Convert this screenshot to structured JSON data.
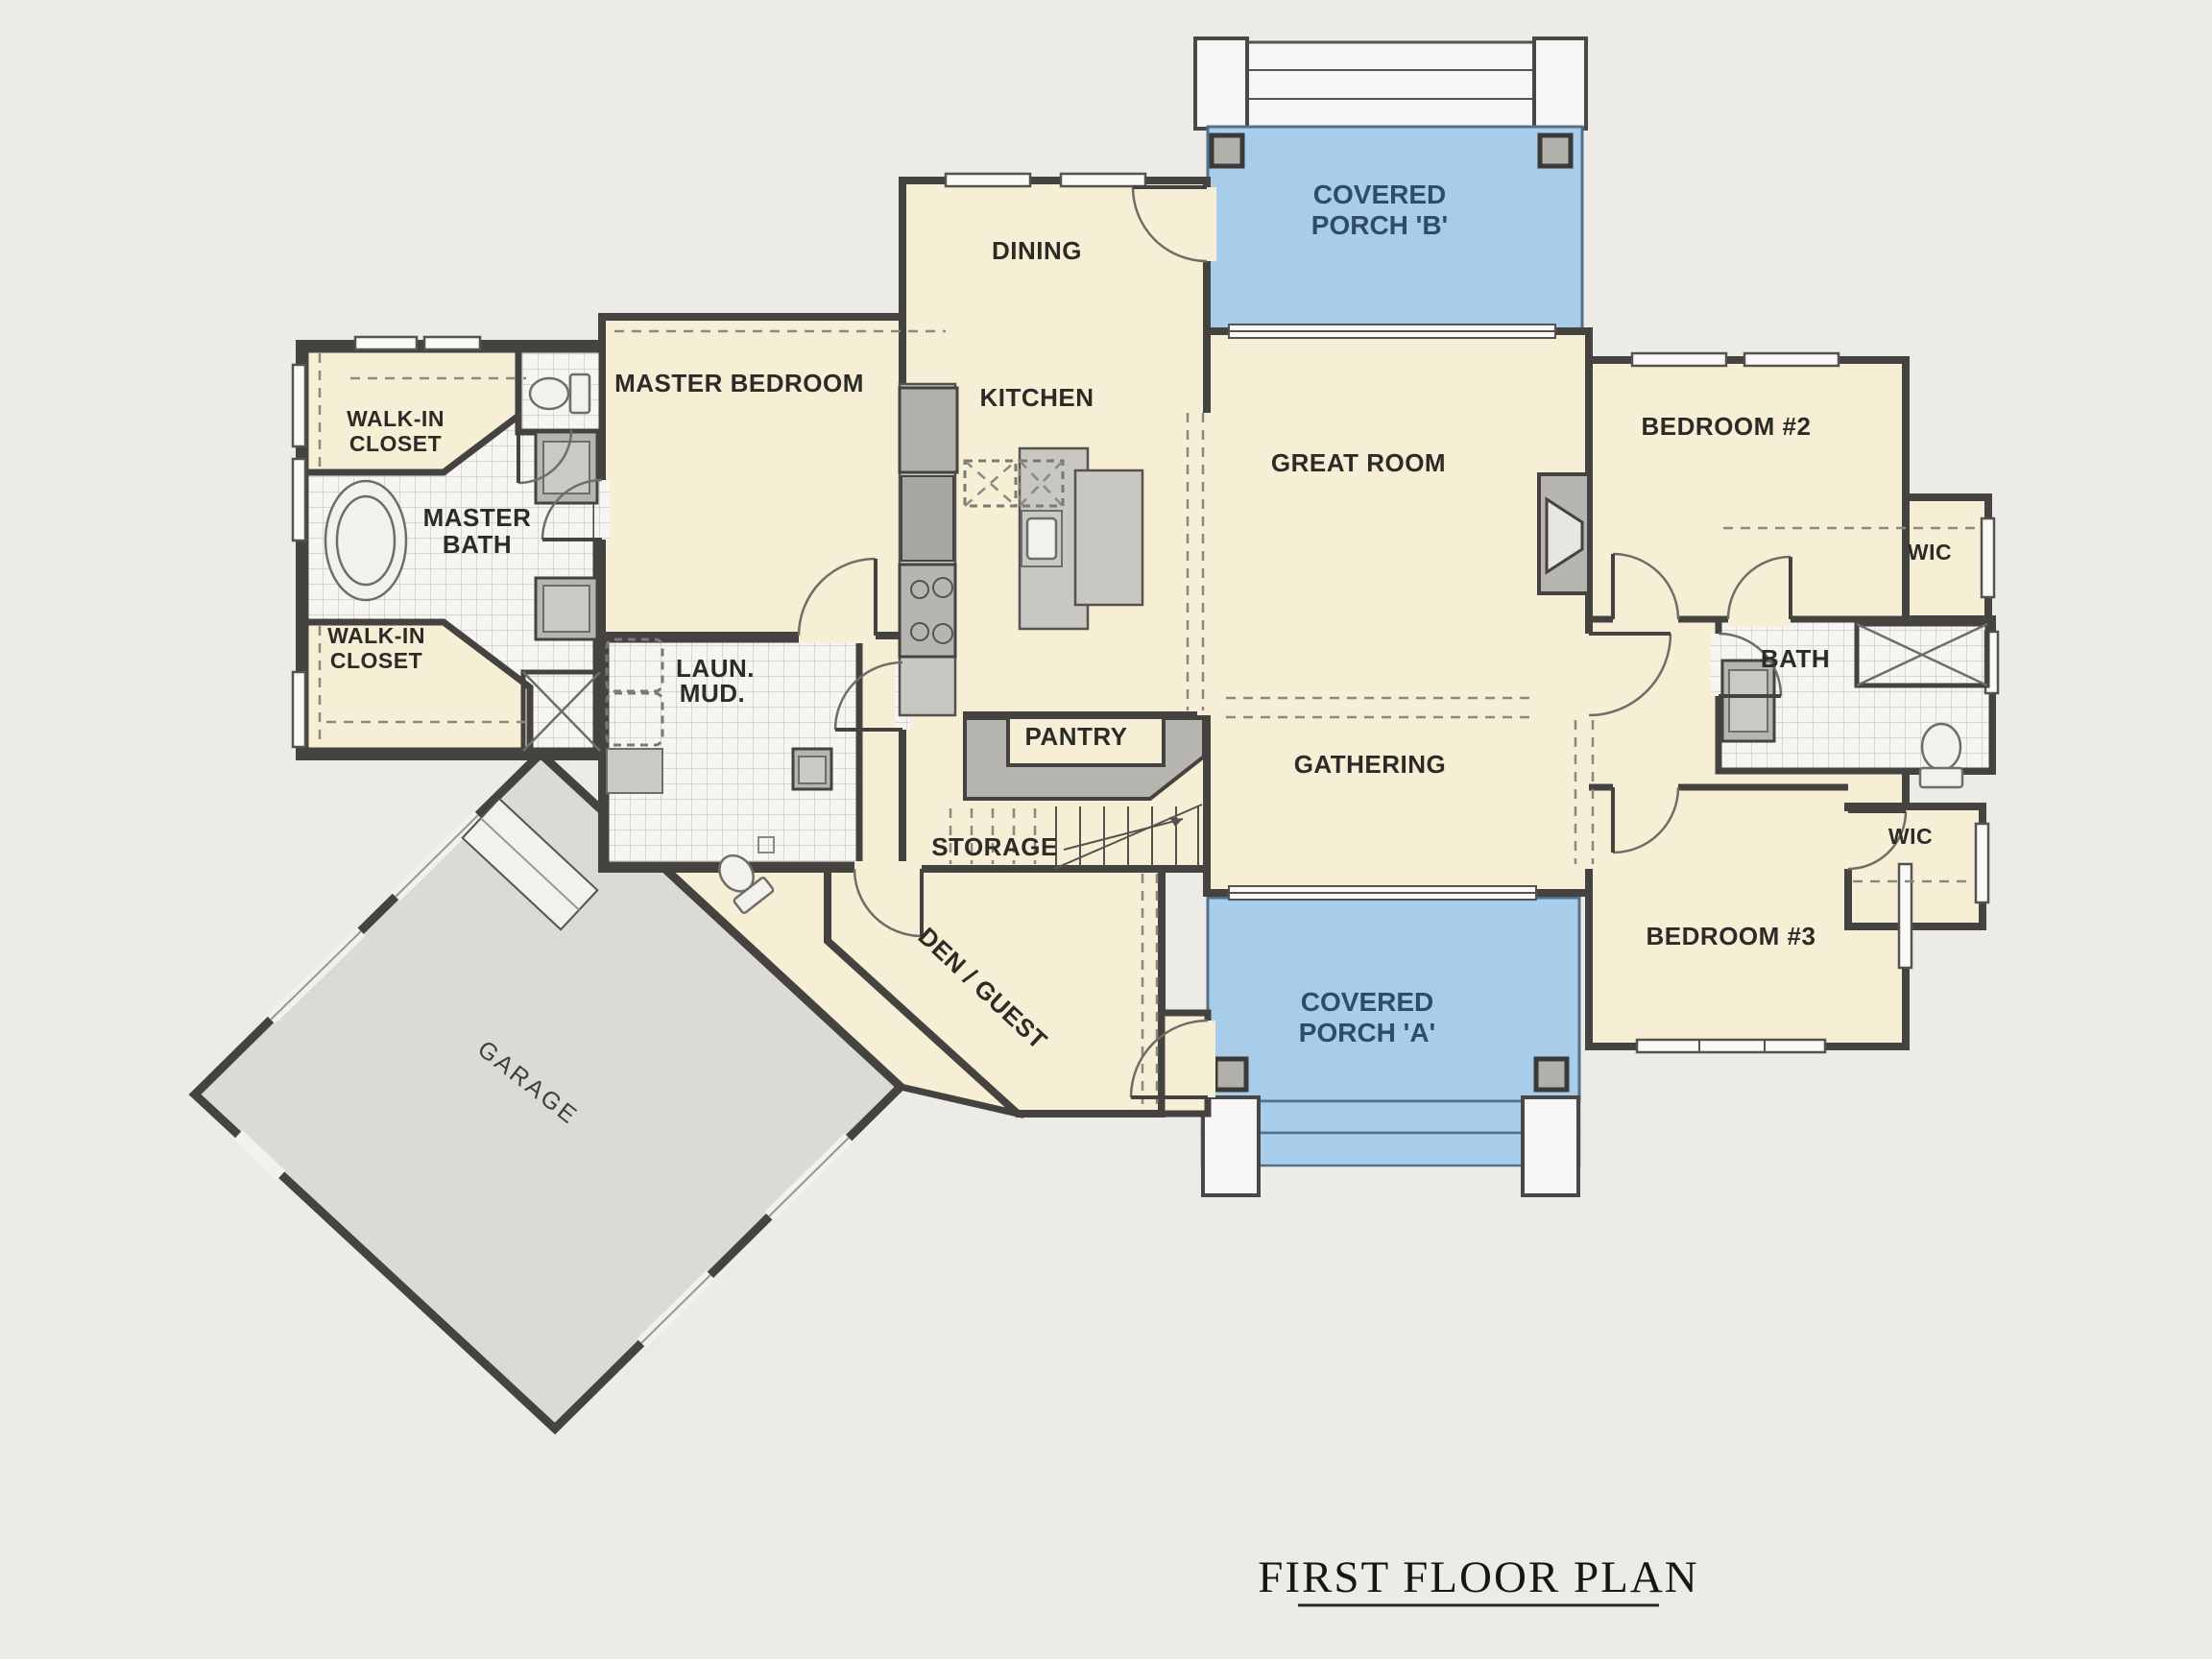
{
  "title": {
    "text": "FIRST FLOOR PLAN"
  },
  "rooms": {
    "covered_porch_b": {
      "line1": "COVERED",
      "line2": "PORCH 'B'"
    },
    "dining": {
      "label": "DINING"
    },
    "master_bedroom": {
      "label": "MASTER BEDROOM"
    },
    "kitchen": {
      "label": "KITCHEN"
    },
    "great_room": {
      "label": "GREAT ROOM"
    },
    "bedroom_2": {
      "label": "BEDROOM #2"
    },
    "wic_upper": {
      "label": "WIC"
    },
    "walk_in_closet_upper": {
      "line1": "WALK-IN",
      "line2": "CLOSET"
    },
    "master_bath": {
      "line1": "MASTER",
      "line2": "BATH"
    },
    "walk_in_closet_lower": {
      "line1": "WALK-IN",
      "line2": "CLOSET"
    },
    "laundry_mud": {
      "line1": "LAUN.",
      "line2": "MUD."
    },
    "pantry": {
      "label": "PANTRY"
    },
    "bath": {
      "label": "BATH"
    },
    "gathering": {
      "label": "GATHERING"
    },
    "storage": {
      "label": "STORAGE"
    },
    "wic_lower": {
      "label": "WIC"
    },
    "bedroom_3": {
      "label": "BEDROOM #3"
    },
    "den_guest": {
      "label": "DEN / GUEST"
    },
    "covered_porch_a": {
      "line1": "COVERED",
      "line2": "PORCH 'A'"
    },
    "garage": {
      "label": "GARAGE"
    }
  },
  "palette": {
    "background": "#ecebe7",
    "room_fill": "#f6efd6",
    "porch_fill": "#a7cdeb",
    "wall": "#45433f",
    "wall_fill": "#b2b0ab",
    "garage_fill": "#dcdad6",
    "tile_bg": "#f6f5f2",
    "tile_line": "#cfccc7",
    "label_color": "#2d2b28",
    "porch_label_color": "#2f4d66",
    "title_color": "#181614"
  }
}
